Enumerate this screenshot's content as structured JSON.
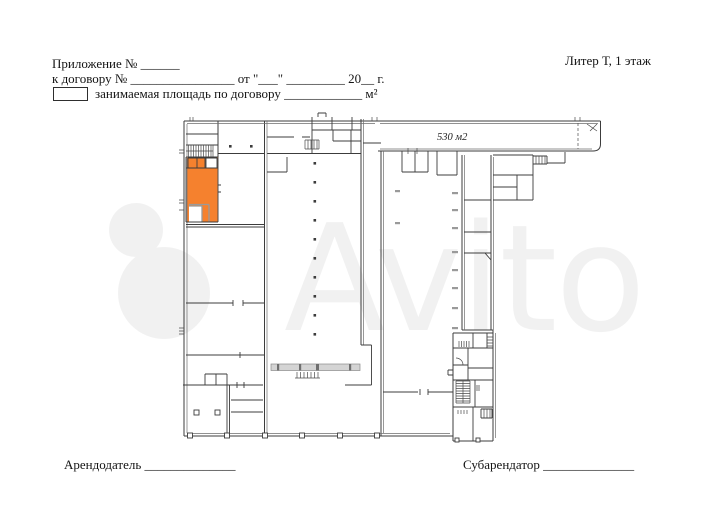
{
  "document": {
    "appendix_line": "Приложение № ______",
    "contract_line": "к договору № ________________ от \"___\" _________ 20__ г.",
    "legend_text": "занимаемая площадь по договору ____________ м²",
    "building_label": "Литер Т, 1 этаж",
    "landlord_line": "Арендодатель ______________",
    "subtenant_line": "Субарендатор ______________"
  },
  "plan": {
    "area_label": "530 м2",
    "highlight_color": "#F5812E",
    "wall_color": "#3C3C3C",
    "light_wall_color": "#6E6E6E",
    "gray_wall_color": "#9A9A9A",
    "conveyor_fill": "#D4D4D4"
  },
  "watermark": {
    "text": "Avito"
  }
}
